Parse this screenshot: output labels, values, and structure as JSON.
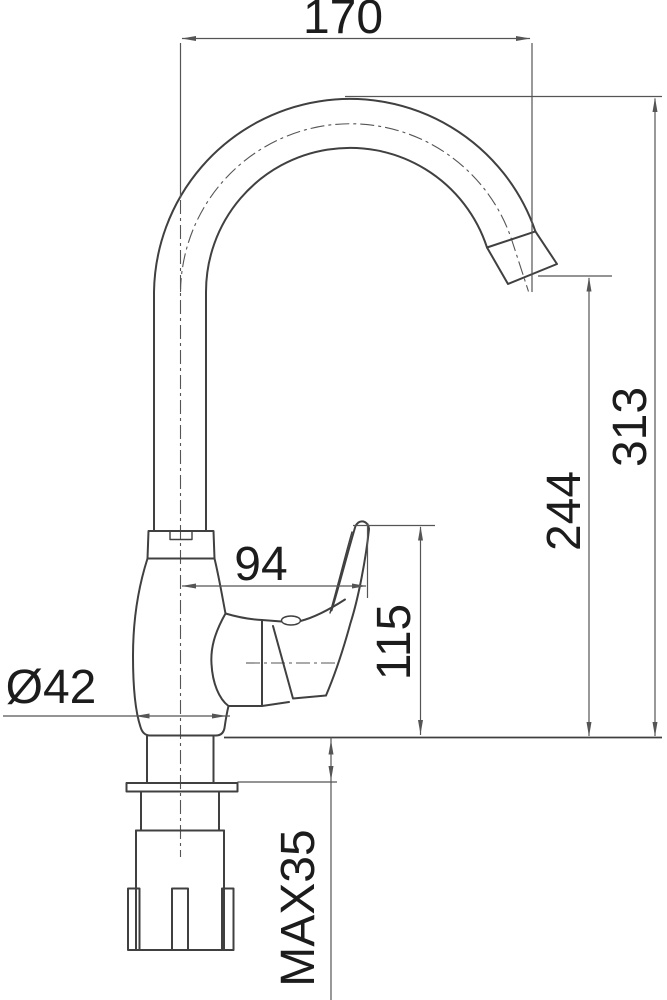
{
  "drawing": {
    "type": "technical-dimension-drawing",
    "subject": "kitchen-faucet-side-view",
    "colors": {
      "background": "#ffffff",
      "line": "#404040",
      "dimension": "#555555",
      "text": "#1c1c1c"
    },
    "dimensions": {
      "width_top": {
        "label": "170"
      },
      "height_total": {
        "label": "313"
      },
      "height_spout_outlet": {
        "label": "244"
      },
      "width_handle": {
        "label": "94"
      },
      "height_handle": {
        "label": "115"
      },
      "base_diameter": {
        "label": "Ø42"
      },
      "max_counter_thickness": {
        "label": "MAX35"
      }
    }
  }
}
